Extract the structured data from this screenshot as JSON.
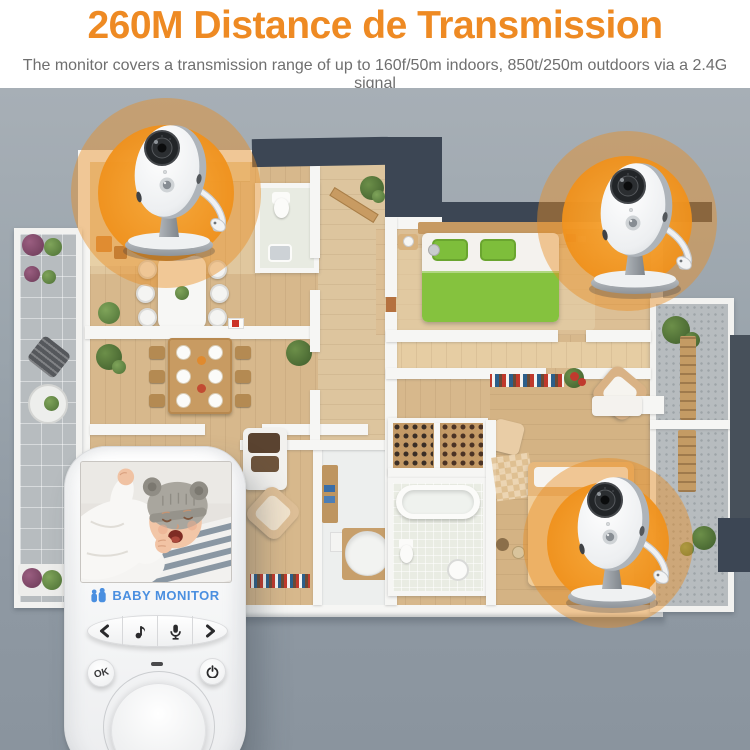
{
  "header": {
    "title": "260M Distance de Transmission",
    "subtitle": "The monitor covers a transmission range of up to 160f/50m indoors, 850t/250m outdoors via a 2.4G signal"
  },
  "colors": {
    "accent_orange": "#EE8A23",
    "glow_orange": "#F0921D",
    "roof_navy": "#3C4654",
    "background_gray": "#99A3AC",
    "brand_blue": "#4A8FE0",
    "bed_green": "#85C23E",
    "wood_floor": "#D7B88C"
  },
  "floor_plan": {
    "rooms": [
      "left-balcony",
      "kitchen",
      "small-bathroom",
      "entry-hall",
      "dining-area",
      "living-room",
      "utility-room",
      "main-bathroom",
      "master-bedroom",
      "corridor",
      "second-bedroom",
      "right-balcony"
    ]
  },
  "cameras": [
    {
      "name": "camera-top-left",
      "location": "kitchen"
    },
    {
      "name": "camera-top-right",
      "location": "master-bedroom"
    },
    {
      "name": "camera-bottom-right",
      "location": "second-bedroom"
    }
  ],
  "monitor": {
    "brand": "BABY MONITOR",
    "ok_label": "OK",
    "buttons": [
      "previous",
      "music",
      "talk",
      "next",
      "ok",
      "power"
    ],
    "screen": "crying baby with gray knit hat"
  }
}
